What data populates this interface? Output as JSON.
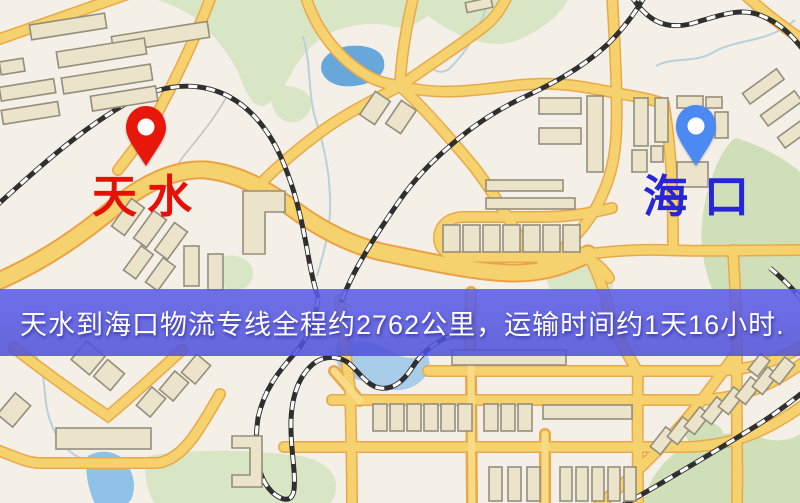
{
  "window": {
    "width": 800,
    "height": 503
  },
  "map": {
    "type": "stylized-road-map",
    "origin_marker": {
      "label": "天水",
      "pin_icon": "red-map-pin",
      "pin_color": "#e8170b",
      "label_color": "#e51107"
    },
    "destination_marker": {
      "label": "海口",
      "pin_icon": "blue-map-pin",
      "pin_color": "#4a8af2",
      "label_color": "#2824d8"
    },
    "banner": {
      "text": "天水到海口物流专线全程约2762公里，运输时间约1天16小时.",
      "background_color": "#5658e4",
      "text_color": "#ffffff"
    }
  },
  "palette": {
    "background": "#f4efe7",
    "road_fill": "#f6d26e",
    "road_casing": "#e9a94a",
    "building_fill": "#ebe4cb",
    "building_outline": "#948e7d",
    "park_green": "#d9e6c6",
    "lake_blue": "#68a7da",
    "shallow_water": "#a9cde8",
    "railway_dark": "#2f2f2f"
  }
}
